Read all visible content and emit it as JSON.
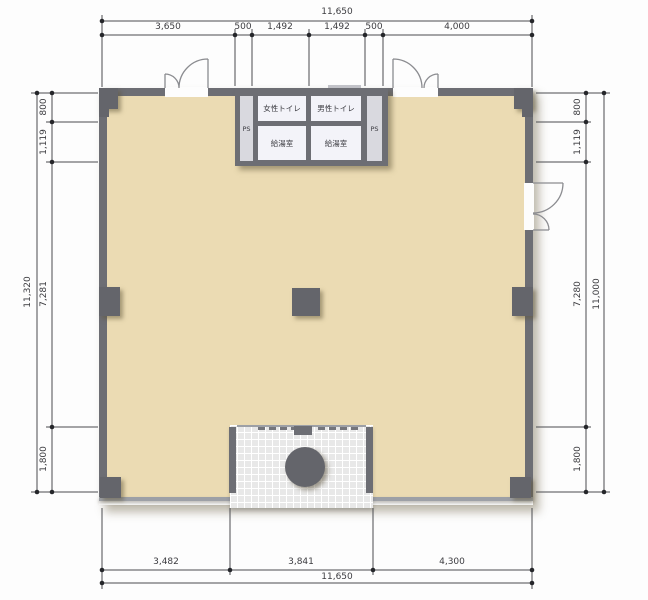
{
  "rooms": {
    "womens_toilet": "女性トイレ",
    "mens_toilet": "男性トイレ",
    "kitchenette_left": "給湯室",
    "kitchenette_right": "給湯室",
    "ps_left": "PS",
    "ps_right": "PS"
  },
  "dimensions": {
    "top": {
      "total": "11,650",
      "segments": [
        "3,650",
        "500",
        "1,492",
        "1,492",
        "500",
        "4,000"
      ]
    },
    "bottom": {
      "total": "11,650",
      "segments": [
        "3,482",
        "3,841",
        "4,300"
      ]
    },
    "left": {
      "total": "11,320",
      "segments": [
        "800",
        "1,119",
        "7,281",
        "1,800"
      ]
    },
    "right": {
      "total": "11,000",
      "segments": [
        "800",
        "1,119",
        "7,280",
        "1,800"
      ]
    }
  },
  "colors": {
    "wall": "#6d6e74",
    "wall_light": "#9da0a6",
    "floor": "#ebdbb3",
    "room": "#f3f3f9",
    "ps": "#d9d9df",
    "tile": "#e8e8e8",
    "column": "#64656b",
    "window": "#c3c4ca",
    "dim": "#4b4c50"
  }
}
